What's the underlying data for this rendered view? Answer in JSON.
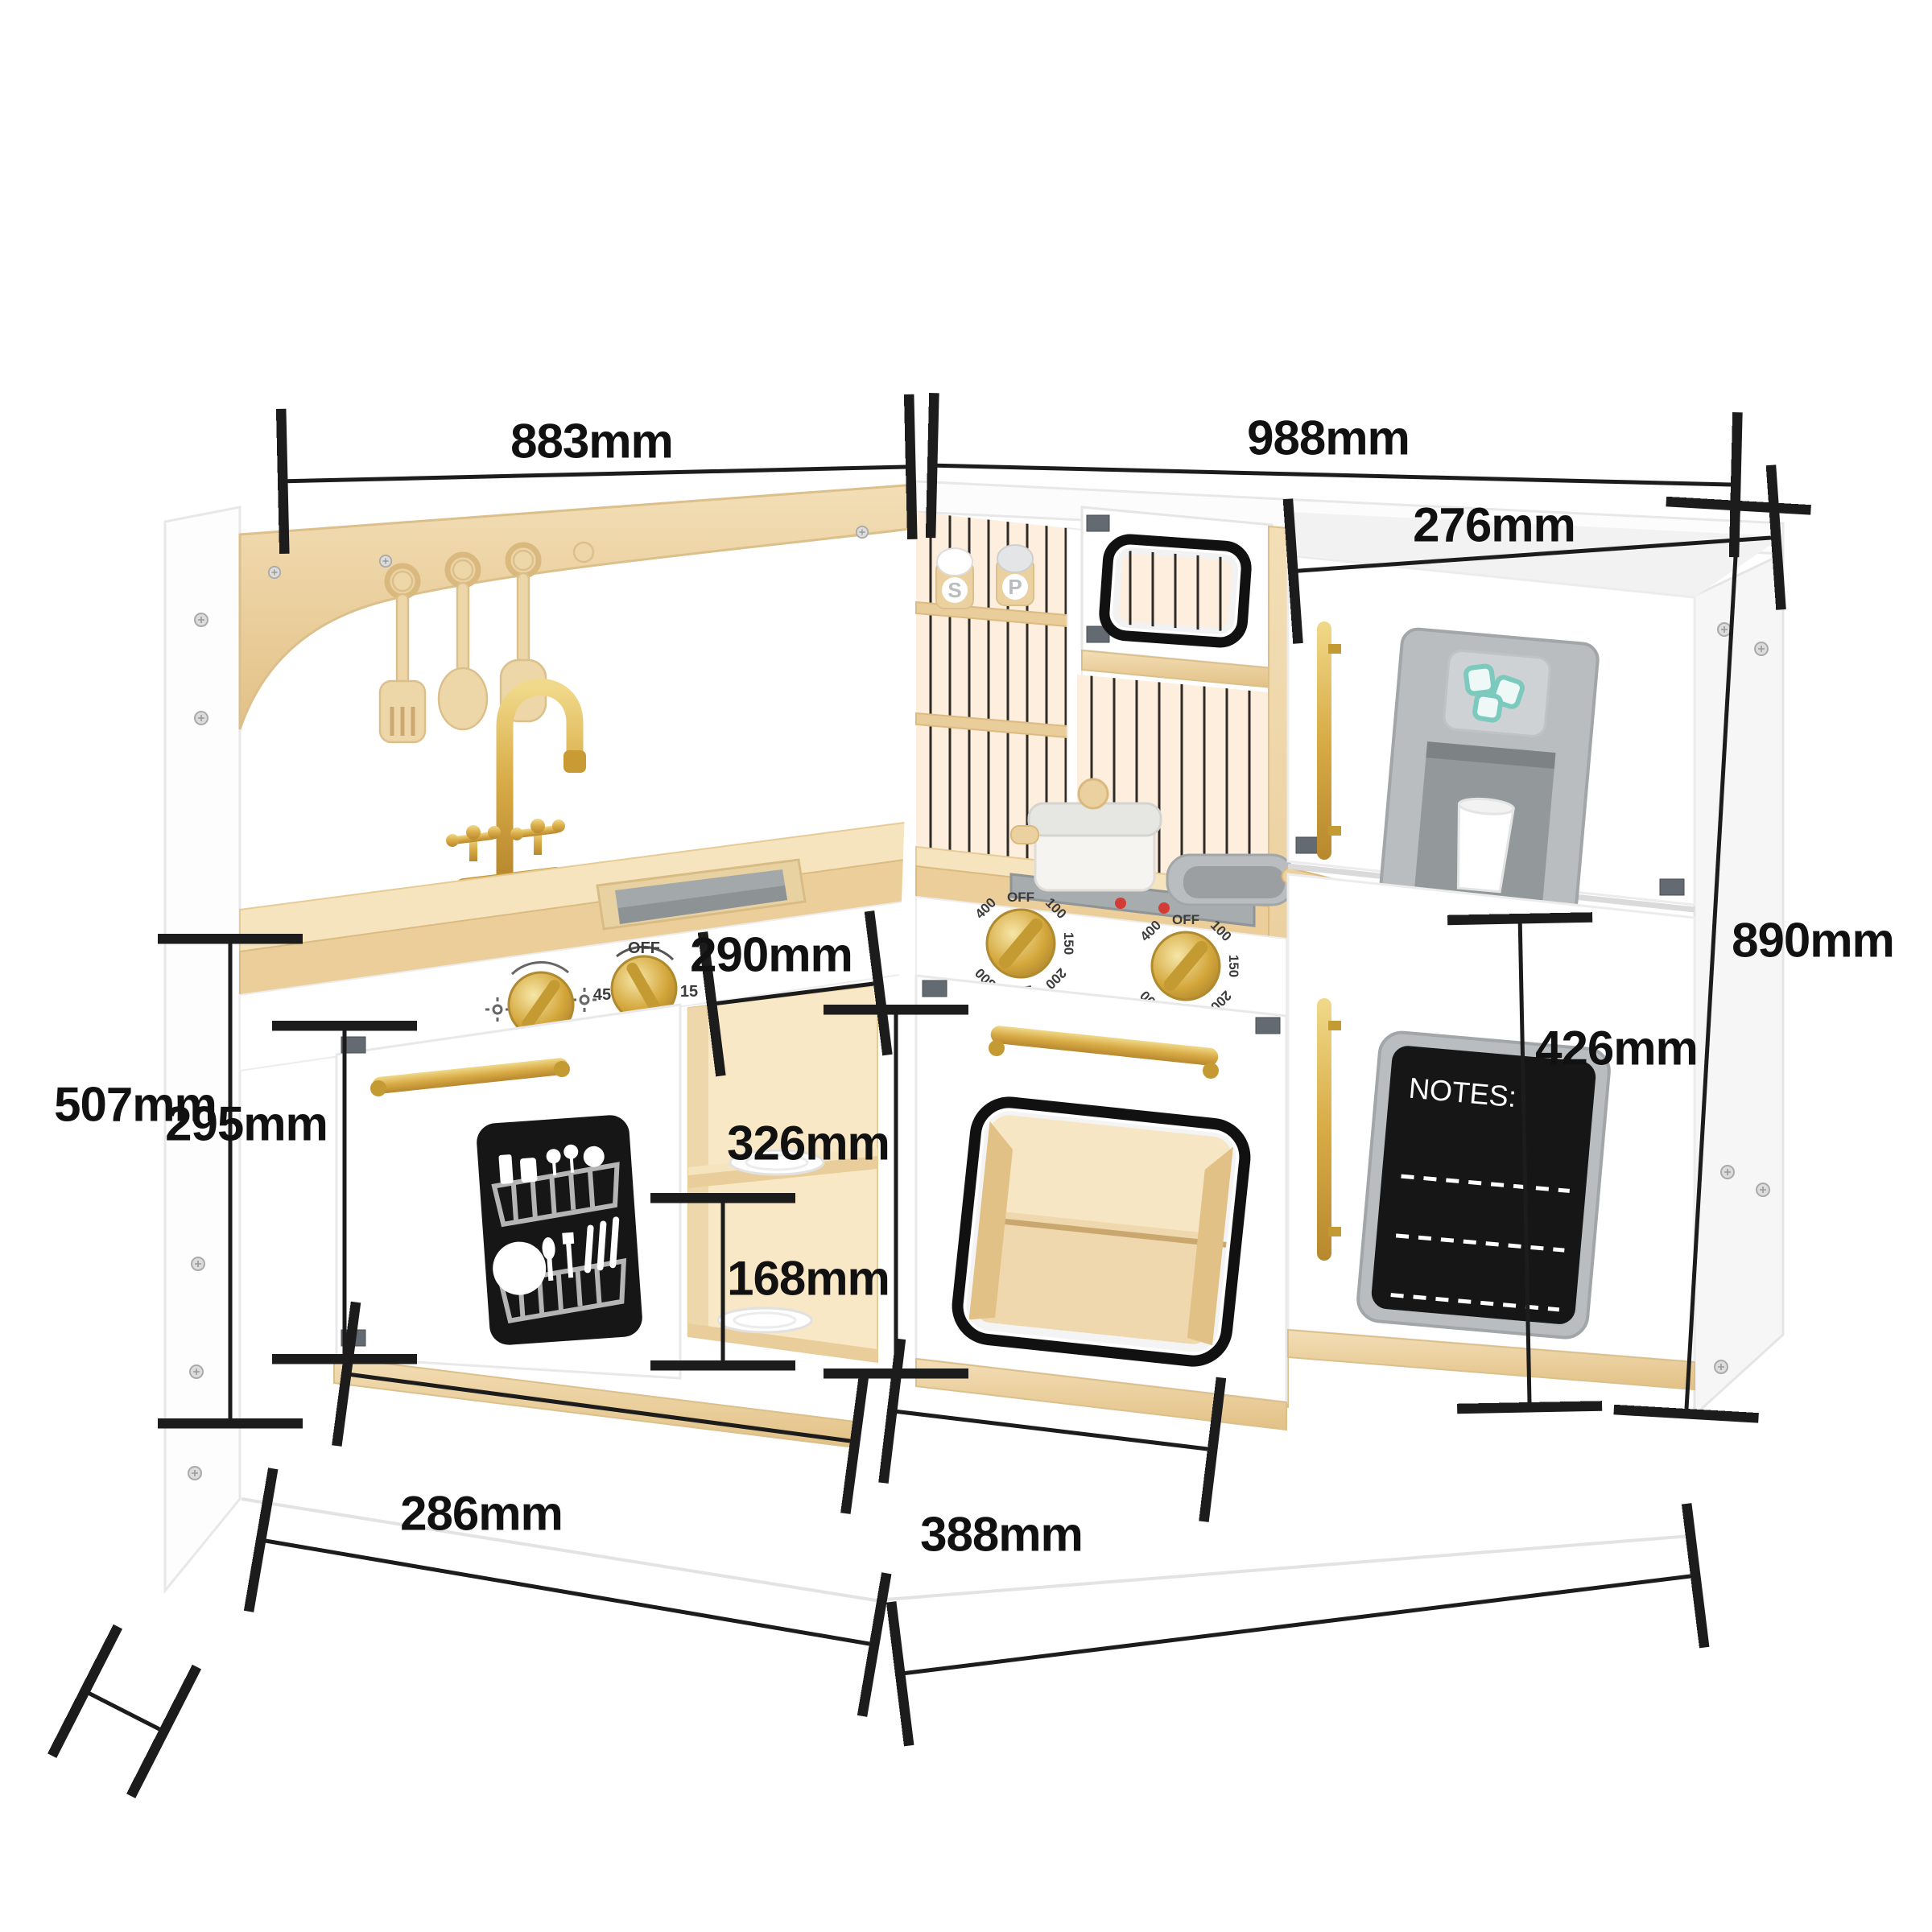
{
  "diagram": {
    "type": "product-dimension-diagram",
    "product": "corner wooden play kitchen",
    "dimensions": {
      "left_width": "883mm",
      "right_width": "988mm",
      "fridge_width": "276mm",
      "total_height": "890mm",
      "fridge_door_height": "426mm",
      "left_unit_height": "507mm",
      "dishwasher_height": "295mm",
      "cubby_width": "290mm",
      "cubby_height": "326mm",
      "cubby_shelf_height": "168mm",
      "dishwasher_width": "286mm",
      "oven_width": "388mm"
    },
    "labels": {
      "notes_board_title": "NOTES:",
      "salt_shaker": "S",
      "pepper_shaker": "P"
    },
    "oven_dial_marks": [
      "OFF",
      "100",
      "150",
      "200",
      "250",
      "300",
      "400"
    ],
    "timer_dial_marks": [
      "OFF",
      "15",
      "30",
      "45"
    ],
    "colors": {
      "wood_light": "#f6e4bf",
      "wood": "#ecce9b",
      "gold": "#d8ab46",
      "appliance_gray": "#b9bdc0",
      "panel_black": "#161616",
      "ice_teal": "#7cc9bd",
      "dimension_line": "#1c1c1c",
      "burner_red": "#d23c34"
    }
  }
}
